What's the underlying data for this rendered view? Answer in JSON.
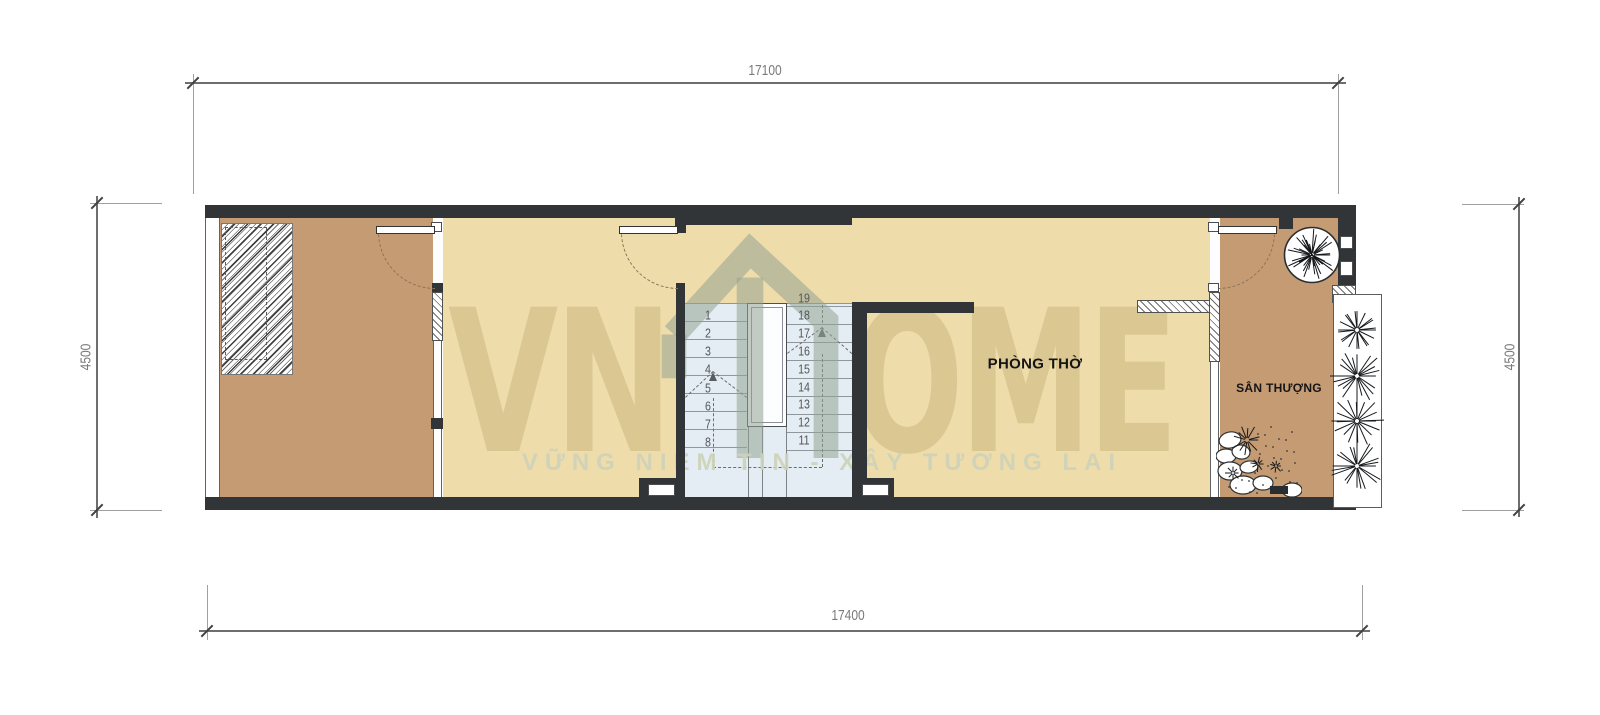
{
  "dimensions": {
    "top": "17100",
    "bottom": "17400",
    "left": "4500",
    "right": "4500"
  },
  "rooms": {
    "worship_room": "PHÒNG THỜ",
    "terrace": "SÂN THƯỢNG"
  },
  "stairs": {
    "left_numbers": [
      "1",
      "2",
      "3",
      "4",
      "5",
      "6",
      "7",
      "8"
    ],
    "right_numbers": [
      "19",
      "18",
      "17",
      "16",
      "15",
      "14",
      "13",
      "12",
      "11"
    ]
  },
  "watermark": {
    "brand_left": "VN",
    "brand_right": "OME",
    "tagline": "VỮNG NIỀM TIN - XÂY TƯƠNG LAI"
  },
  "colors": {
    "wall": "#313538",
    "floor_tan": "#c59b74",
    "floor_cream": "#efdcab",
    "stair_floor": "#e4edf3",
    "label_text": "#151515",
    "dimension_text": "#7a7a7a",
    "watermark_khaki": "#887434",
    "watermark_sage": "#94a292"
  }
}
